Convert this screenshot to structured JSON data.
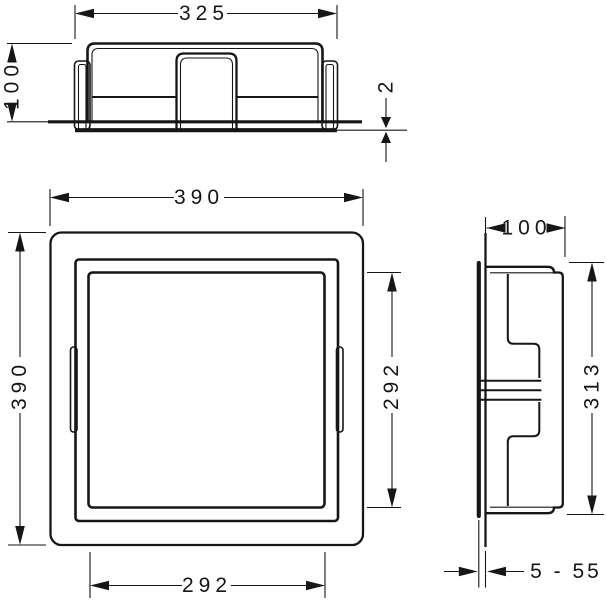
{
  "colors": {
    "background": "#ffffff",
    "line": "#161616"
  },
  "dimensions": {
    "top_view": {
      "width": "325",
      "depth": "100",
      "protrusion": "2"
    },
    "front_view": {
      "width": "390",
      "height": "390",
      "opening_width": "292",
      "opening_height": "292"
    },
    "side_view": {
      "depth": "100",
      "height": "313",
      "adjust_range": "5 - 55"
    }
  }
}
